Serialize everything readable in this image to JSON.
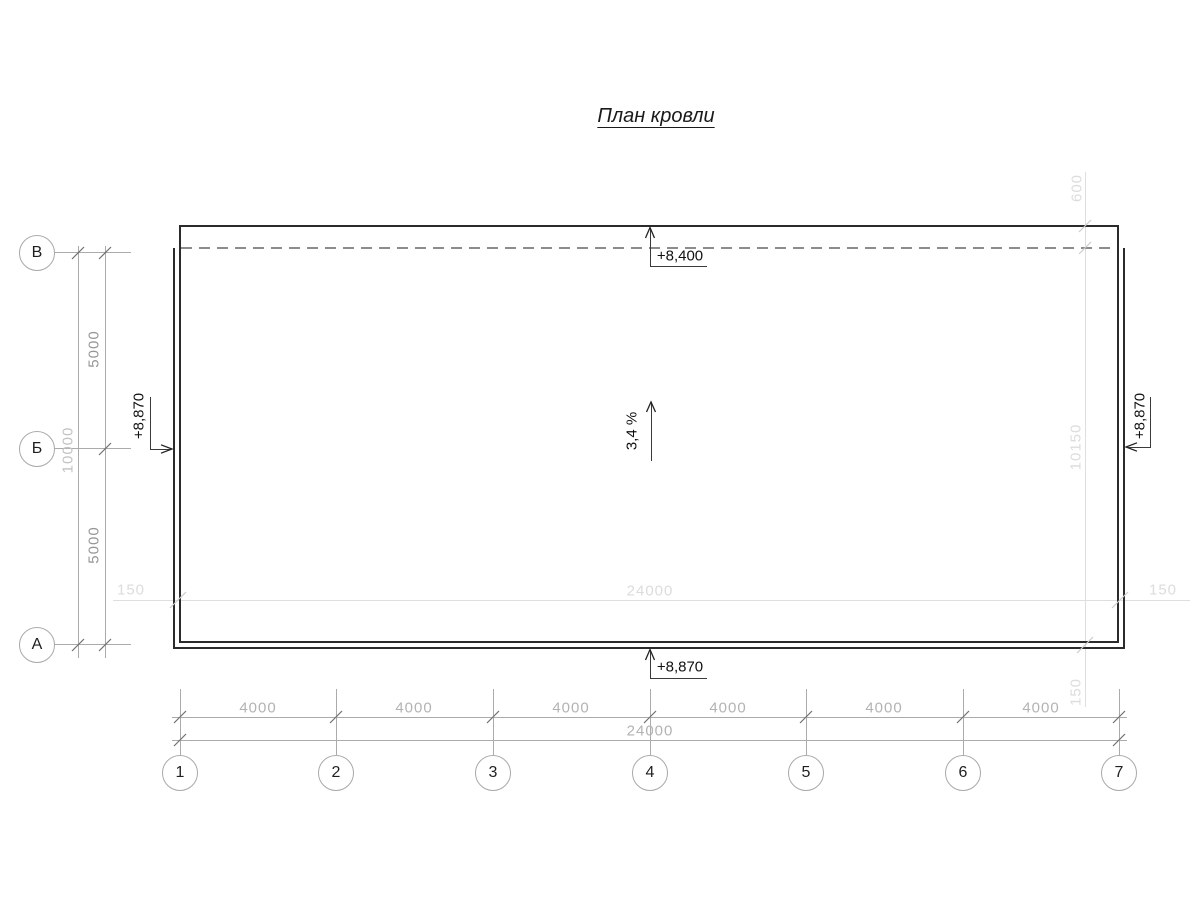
{
  "title": "План кровли",
  "annotations": {
    "slope": "3,4 %",
    "elevation_top": "+8,400",
    "elevation_bottom": "+8,870",
    "elevation_left": "+8,870",
    "elevation_right": "+8,870"
  },
  "axes": {
    "rows": [
      {
        "label": "В"
      },
      {
        "label": "Б"
      },
      {
        "label": "А"
      }
    ],
    "columns": [
      {
        "label": "1"
      },
      {
        "label": "2"
      },
      {
        "label": "3"
      },
      {
        "label": "4"
      },
      {
        "label": "5"
      },
      {
        "label": "6"
      },
      {
        "label": "7"
      }
    ]
  },
  "dimensions": {
    "left_spans": [
      "5000",
      "5000"
    ],
    "left_total": "10000",
    "bottom_spans": [
      "4000",
      "4000",
      "4000",
      "4000",
      "4000",
      "4000"
    ],
    "bottom_total": "24000",
    "plan_width": {
      "left_offset": "150",
      "middle": "24000",
      "right_offset": "150"
    },
    "plan_height": {
      "top": "600",
      "middle": "10150",
      "bottom": "150"
    }
  },
  "colors": {
    "outline": "#2b2b2b",
    "annotation_text": "#111111",
    "dimension_line": "#ababab",
    "dimension_text_medium": "#969696",
    "dimension_text_light": "#c2c2c2",
    "construction": "#dedede",
    "dashed_line": "#8c8c8c"
  }
}
